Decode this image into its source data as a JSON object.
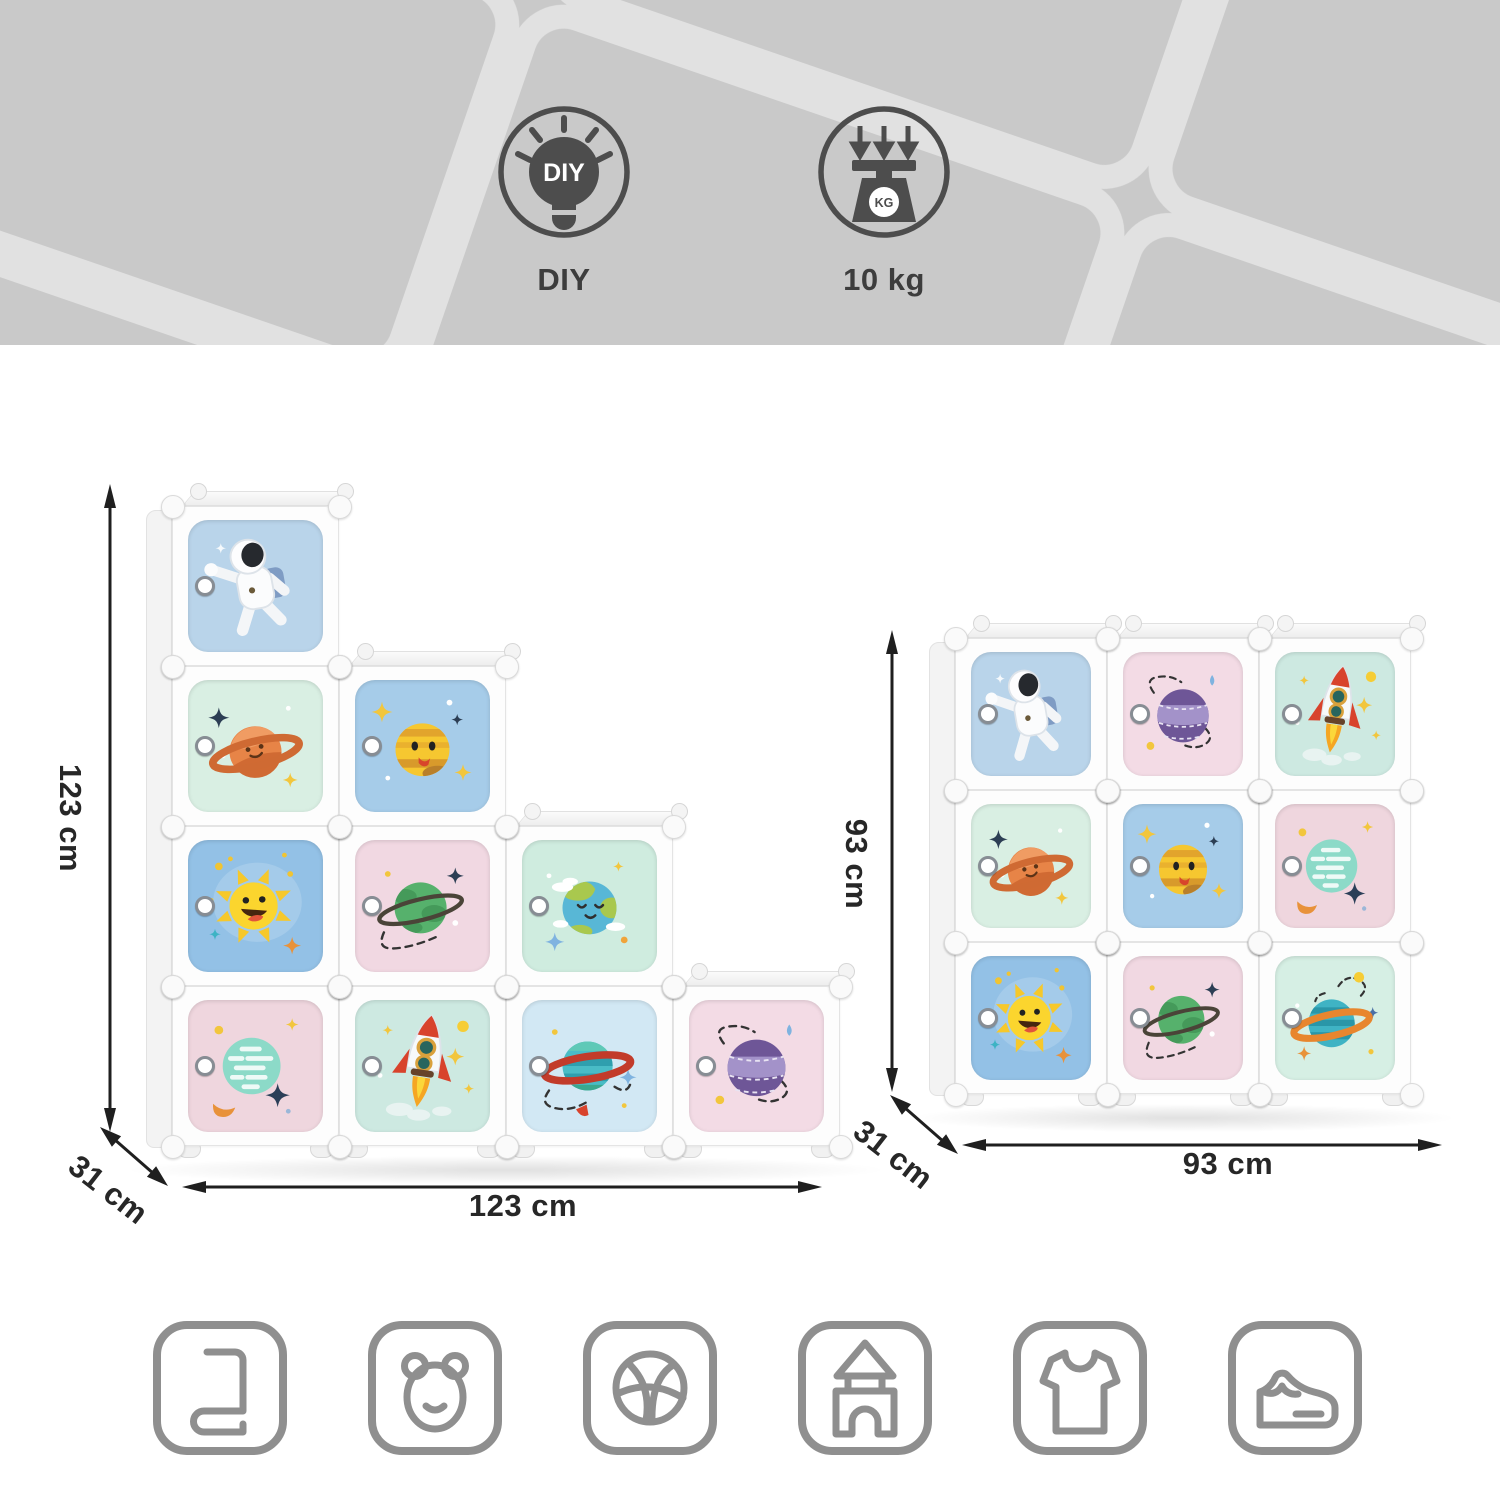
{
  "banner": {
    "background_color": "#c9c9c9",
    "pattern_line_color": "#e1e1e1",
    "features": [
      {
        "name": "diy-assembly",
        "icon": "diy-lightbulb-icon",
        "bulb_text": "DIY",
        "label": "DIY"
      },
      {
        "name": "max-load",
        "icon": "weight-scale-icon",
        "scale_text": "KG",
        "label": "10 kg"
      }
    ]
  },
  "shelves": [
    {
      "id": "staircase-configuration",
      "height_label": "123 cm",
      "depth_label": "31 cm",
      "width_label": "123 cm",
      "rows": [
        [
          "astronaut"
        ],
        [
          "saturn-orange",
          "yellow-smiley-planet"
        ],
        [
          "smiley-sun",
          "green-ringed-planet",
          "smiley-earth"
        ],
        [
          "teal-dashed-planet",
          "rocket",
          "teal-red-ringed-planet",
          "purple-planet"
        ]
      ]
    },
    {
      "id": "grid-configuration",
      "height_label": "93 cm",
      "depth_label": "31 cm",
      "width_label": "93 cm",
      "rows": [
        [
          "astronaut",
          "purple-planet",
          "rocket"
        ],
        [
          "saturn-orange",
          "yellow-smiley-planet",
          "teal-dashed-planet"
        ],
        [
          "smiley-sun",
          "green-ringed-planet",
          "teal-orange-ringed-planet"
        ]
      ]
    }
  ],
  "cube_backgrounds": {
    "astronaut": "#b9d4ea",
    "saturn-orange": "#d9efe3",
    "yellow-smiley-planet": "#a6cce9",
    "smiley-sun": "#93c1e6",
    "green-ringed-planet": "#f1d8e2",
    "smiley-earth": "#cfecdf",
    "teal-dashed-planet": "#efd6de",
    "rocket": "#cde9e1",
    "teal-red-ringed-planet": "#d2e8f4",
    "purple-planet": "#f3dbe5",
    "teal-orange-ringed-planet": "#d6efe4"
  },
  "dimension_text_color": "#272727",
  "suitable_for_icons": [
    {
      "icon": "book-icon"
    },
    {
      "icon": "teddy-bear-icon"
    },
    {
      "icon": "ball-icon"
    },
    {
      "icon": "toy-castle-icon"
    },
    {
      "icon": "tshirt-icon"
    },
    {
      "icon": "shoe-icon"
    }
  ]
}
